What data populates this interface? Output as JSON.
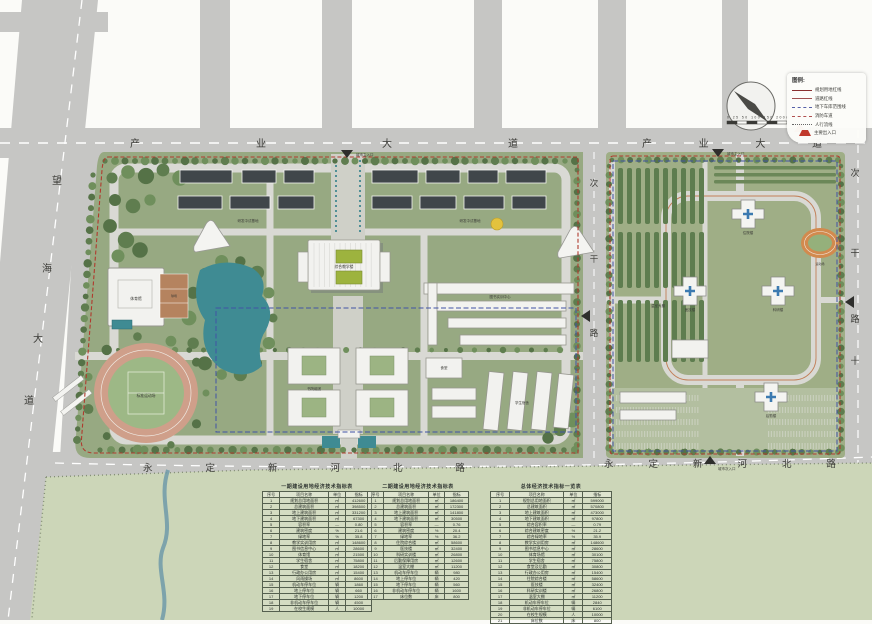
{
  "roads": {
    "chanye_west": "产业大道",
    "chanye_east": "产业大道",
    "yongding_west": "永定新河北路",
    "yongding_east": "永定新河北路",
    "wanghai": {
      "chars": [
        "望",
        "海",
        "大",
        "道"
      ]
    },
    "cigan": {
      "chars": [
        "次",
        "干",
        "路"
      ]
    },
    "cross_mark": "十"
  },
  "markers": {
    "main": "城市主入口",
    "secondary": "城市次入口"
  },
  "legend": {
    "title": "图例:",
    "items": [
      {
        "style": "solid-red",
        "label": "规划用地红线"
      },
      {
        "style": "solid-dark",
        "label": "道路红线"
      },
      {
        "style": "dash-blue",
        "label": "地下车库范围线"
      },
      {
        "style": "dash-red",
        "label": "消防车道"
      },
      {
        "style": "dot-gray",
        "label": "人行流线"
      },
      {
        "style": "tri-red",
        "label": "主要出入口"
      }
    ]
  },
  "scalebar": {
    "label": "0  25  50   100   150   200m"
  },
  "buildings": {
    "west": {
      "teaching": "综合教学楼",
      "lib": "图书实训中心",
      "gym": "体育馆",
      "stadium": "标准运动场",
      "dorm": "学生宿舍",
      "canteen": "食堂",
      "college": "书院组团",
      "rnd": "研发中试基地",
      "courts": "球场"
    },
    "east": {
      "inpatient": "住院楼",
      "medtech": "医技楼",
      "research": "科研楼",
      "logistics": "后勤楼",
      "greenhouse": "温室大棚",
      "sports": "运动场"
    }
  },
  "colors": {
    "boundary_red": "#b03a2e",
    "garage_blue": "#4053a5",
    "water": "#3f8b93",
    "campus_green": "#97a982",
    "road_gray": "#c6c6c4"
  },
  "tables": [
    {
      "title": "一期建设用地经济技术指标表",
      "columns": [
        "序号",
        "项目名称",
        "单位",
        "指标"
      ],
      "rows": [
        [
          "1",
          "规划总用地面积",
          "㎡",
          "412600"
        ],
        [
          "2",
          "总建筑面积",
          "㎡",
          "398500"
        ],
        [
          "3",
          "地上建筑面积",
          "㎡",
          "331200"
        ],
        [
          "4",
          "地下建筑面积",
          "㎡",
          "67300"
        ],
        [
          "5",
          "容积率",
          "—",
          "0.80"
        ],
        [
          "6",
          "建筑密度",
          "%",
          "21.6"
        ],
        [
          "7",
          "绿地率",
          "%",
          "35.8"
        ],
        [
          "8",
          "教学实训用房",
          "㎡",
          "148600"
        ],
        [
          "9",
          "图书信息中心",
          "㎡",
          "28600"
        ],
        [
          "10",
          "体育馆",
          "㎡",
          "21500"
        ],
        [
          "11",
          "学生宿舍",
          "㎡",
          "75800"
        ],
        [
          "12",
          "食堂",
          "㎡",
          "18200"
        ],
        [
          "13",
          "行政办公用房",
          "㎡",
          "15400"
        ],
        [
          "14",
          "风雨操场",
          "㎡",
          "8600"
        ],
        [
          "15",
          "机动车停车位",
          "辆",
          "1860"
        ],
        [
          "16",
          "地上停车位",
          "辆",
          "660"
        ],
        [
          "17",
          "地下停车位",
          "辆",
          "1200"
        ],
        [
          "18",
          "非机动车停车位",
          "辆",
          "4500"
        ],
        [
          "19",
          "在校生规模",
          "人",
          "10000"
        ]
      ]
    },
    {
      "title": "二期建设用地经济技术指标表",
      "columns": [
        "序号",
        "项目名称",
        "单位",
        "指标"
      ],
      "rows": [
        [
          "1",
          "规划总用地面积",
          "㎡",
          "186400"
        ],
        [
          "2",
          "总建筑面积",
          "㎡",
          "172300"
        ],
        [
          "3",
          "地上建筑面积",
          "㎡",
          "141800"
        ],
        [
          "4",
          "地下建筑面积",
          "㎡",
          "30500"
        ],
        [
          "5",
          "容积率",
          "—",
          "0.76"
        ],
        [
          "6",
          "建筑密度",
          "%",
          "20.4"
        ],
        [
          "7",
          "绿地率",
          "%",
          "36.2"
        ],
        [
          "8",
          "住院综合楼",
          "㎡",
          "58600"
        ],
        [
          "9",
          "医技楼",
          "㎡",
          "32400"
        ],
        [
          "10",
          "科研实训楼",
          "㎡",
          "26800"
        ],
        [
          "11",
          "后勤保障用房",
          "㎡",
          "12600"
        ],
        [
          "12",
          "温室大棚",
          "㎡",
          "11200"
        ],
        [
          "13",
          "机动车停车位",
          "辆",
          "980"
        ],
        [
          "14",
          "地上停车位",
          "辆",
          "420"
        ],
        [
          "15",
          "地下停车位",
          "辆",
          "560"
        ],
        [
          "16",
          "非机动车停车位",
          "辆",
          "1600"
        ],
        [
          "17",
          "床位数",
          "床",
          "800"
        ]
      ]
    },
    {
      "title": "总体经济技术指标一览表",
      "columns": [
        "序号",
        "项目名称",
        "单位",
        "指标"
      ],
      "rows": [
        [
          "1",
          "规划总用地面积",
          "㎡",
          "599000"
        ],
        [
          "2",
          "总建筑面积",
          "㎡",
          "570800"
        ],
        [
          "3",
          "地上建筑面积",
          "㎡",
          "473000"
        ],
        [
          "4",
          "地下建筑面积",
          "㎡",
          "97800"
        ],
        [
          "5",
          "综合容积率",
          "—",
          "0.79"
        ],
        [
          "6",
          "综合建筑密度",
          "%",
          "21.2"
        ],
        [
          "7",
          "综合绿地率",
          "%",
          "35.9"
        ],
        [
          "8",
          "教学实训用房",
          "㎡",
          "148600"
        ],
        [
          "9",
          "图书信息中心",
          "㎡",
          "28600"
        ],
        [
          "10",
          "体育场馆",
          "㎡",
          "30100"
        ],
        [
          "11",
          "学生宿舍",
          "㎡",
          "75800"
        ],
        [
          "12",
          "食堂及后勤",
          "㎡",
          "30800"
        ],
        [
          "13",
          "行政办公用房",
          "㎡",
          "15400"
        ],
        [
          "14",
          "住院综合楼",
          "㎡",
          "58600"
        ],
        [
          "15",
          "医技楼",
          "㎡",
          "32400"
        ],
        [
          "16",
          "科研实训楼",
          "㎡",
          "26800"
        ],
        [
          "17",
          "温室大棚",
          "㎡",
          "11200"
        ],
        [
          "18",
          "机动车停车位",
          "辆",
          "2840"
        ],
        [
          "19",
          "非机动车停车位",
          "辆",
          "6100"
        ],
        [
          "20",
          "在校生规模",
          "人",
          "10000"
        ],
        [
          "21",
          "床位数",
          "床",
          "800"
        ]
      ]
    }
  ]
}
